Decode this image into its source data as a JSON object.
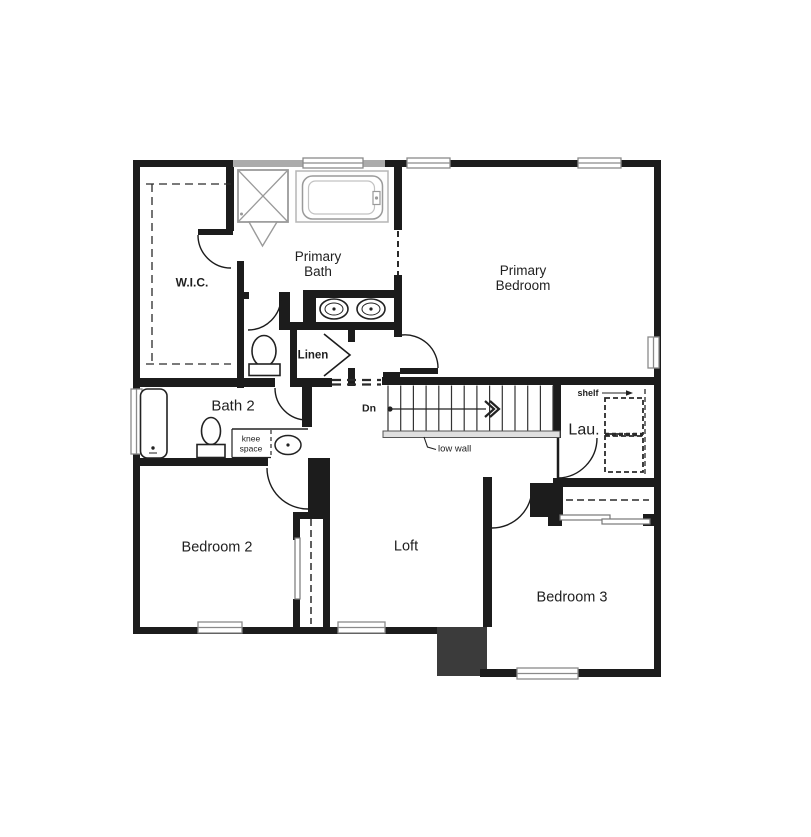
{
  "floor_plan": {
    "rooms": {
      "wic": {
        "label": "W.I.C."
      },
      "primary_bath": {
        "line1": "Primary",
        "line2": "Bath"
      },
      "primary_bedroom": {
        "line1": "Primary",
        "line2": "Bedroom"
      },
      "bath2": {
        "label": "Bath 2"
      },
      "bedroom2": {
        "label": "Bedroom 2"
      },
      "loft": {
        "label": "Loft"
      },
      "bedroom3": {
        "label": "Bedroom 3"
      },
      "laundry": {
        "label": "Lau."
      }
    },
    "annotations": {
      "linen": "Linen",
      "knee_space_line1": "knee",
      "knee_space_line2": "space",
      "stairs_direction": "Dn",
      "low_wall": "low wall",
      "shelf": "shelf"
    },
    "colors": {
      "wall": "#1c1c1c",
      "gray_wall": "#ababab",
      "chase_fill": "#3b3b3b",
      "fixture_gray": "#9a9a9a",
      "low_wall_fill": "#e0e0e0"
    }
  }
}
